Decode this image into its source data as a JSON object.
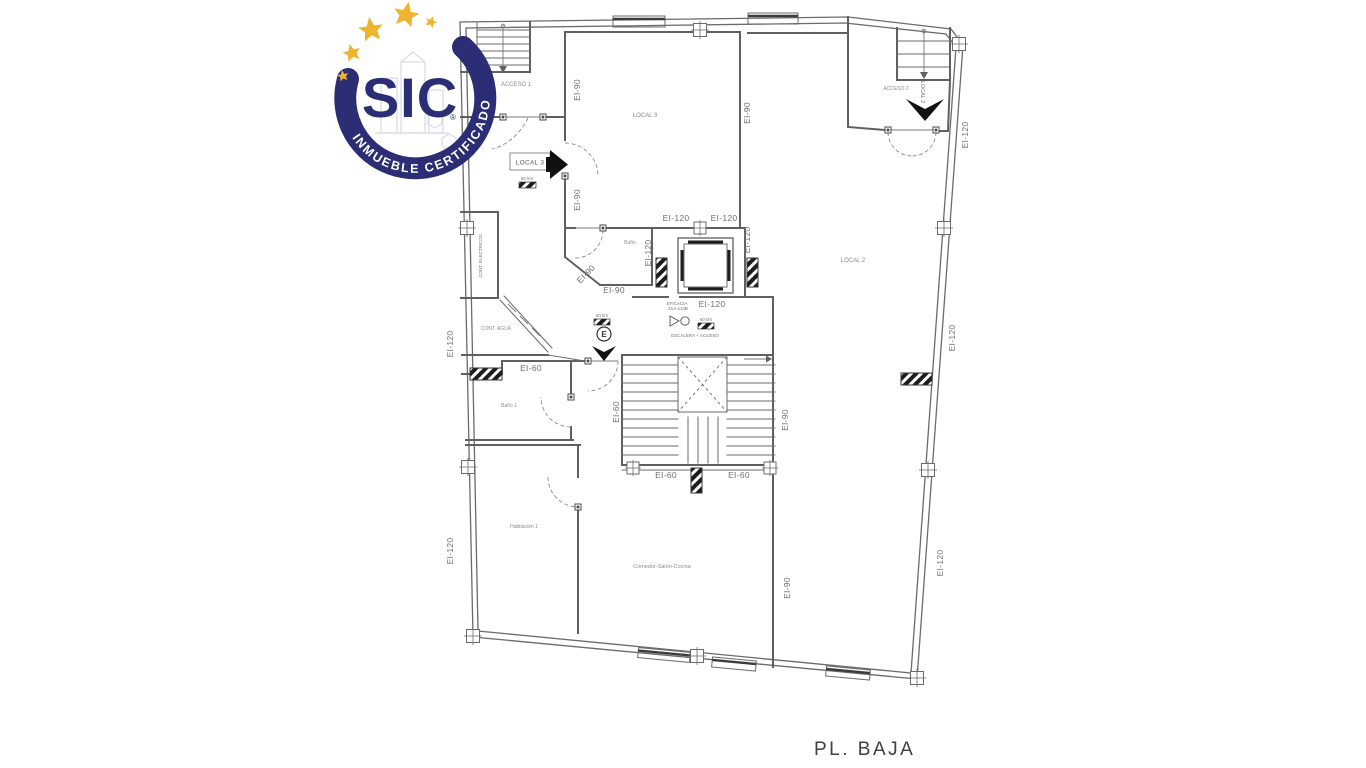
{
  "logo": {
    "brand": "SIC",
    "registered": "®",
    "tagline": "INMUEBLE CERTIFICADO",
    "colors": {
      "navy": "#2b2e74",
      "gold": "#efb42d"
    },
    "star_count": 5
  },
  "drawing": {
    "title": "PL. BAJA",
    "rooms": {
      "acceso1": "ACCESO 1",
      "acceso2": "ACCESO 2",
      "local3": "LOCAL 3",
      "local2": "LOCAL 2",
      "bano": "Baño",
      "bano1": "Baño 1",
      "habitacion1": "Habitación 1",
      "comedor": "Comedor-Salón-Cocina",
      "cont_electricos": "CONT. ELECTRICOS",
      "cont_agua": "CONT. AGUA"
    },
    "signs": {
      "local3_sign": "LOCAL 3",
      "local2_dir": "LOCAL 2",
      "exit_letter": "E",
      "flow_rate": "60 l/m",
      "eficacia_line1": "EFICACIA",
      "eficacia_line2": "21A-113B",
      "escalera": "ESCALERA + ACCESO"
    },
    "fire": {
      "ei60": "EI-60",
      "ei90": "EI-90",
      "ei120": "EI-120"
    },
    "line_color": "#5f6062",
    "text_color": "#8a8c8e"
  }
}
